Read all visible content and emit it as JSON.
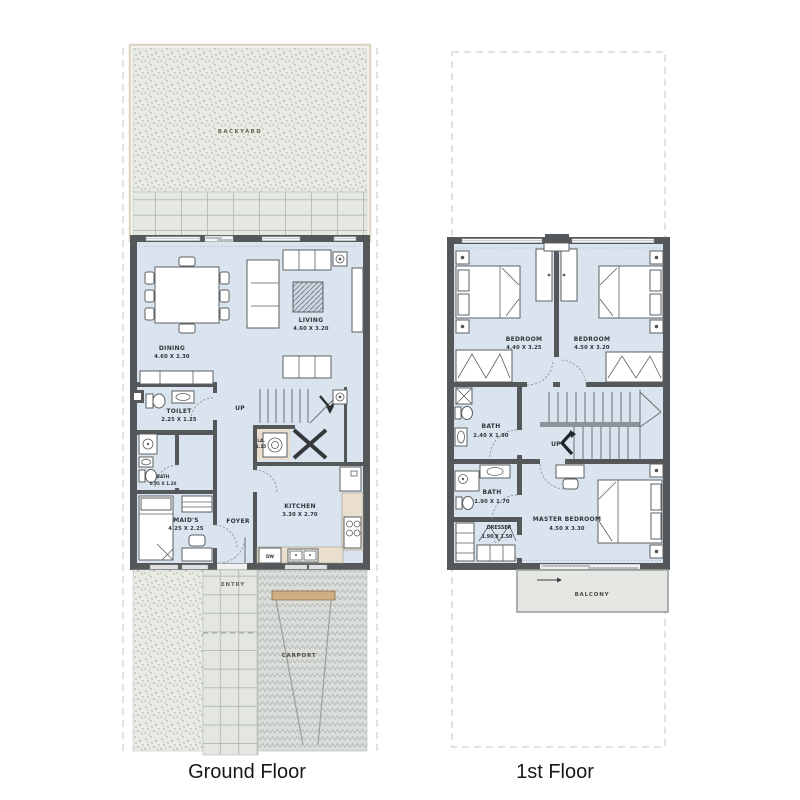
{
  "titles": {
    "ground": "Ground Floor",
    "first": "1st Floor"
  },
  "colors": {
    "wall": "#54585a",
    "floor": "#d9e4ee",
    "counter_tan": "#eadfcf",
    "beam_tan": "#d0ad83",
    "balcony_gray": "#e4e7e2",
    "gravel": "#e9ebe5",
    "tile": "#e6e9e3"
  },
  "ground_floor": {
    "outdoor": {
      "backyard": "BACKYARD",
      "entry": "ENTRY",
      "carport": "CARPORT"
    },
    "rooms": {
      "dining": {
        "name": "DINING",
        "dims": "4.60 X 2.30"
      },
      "living": {
        "name": "LIVING",
        "dims": "4.60 X 3.20"
      },
      "toilet": {
        "name": "TOILET",
        "dims": "2.25 X 1.25"
      },
      "bath": {
        "name": "BATH",
        "dims": "0.95 X 1.20"
      },
      "maids": {
        "name": "MAID'S",
        "dims": "4.25 X 2.25"
      },
      "foyer": {
        "name": "FOYER"
      },
      "kitchen": {
        "name": "KITCHEN",
        "dims": "3.30 X 2.70"
      },
      "laundry": {
        "name": "LA.",
        "dims": "1.15"
      }
    },
    "annotations": {
      "up": "UP",
      "dw": "DW"
    }
  },
  "first_floor": {
    "rooms": {
      "bedroom_left": {
        "name": "BEDROOM",
        "dims": "4.40 X 3.25"
      },
      "bedroom_right": {
        "name": "BEDROOM",
        "dims": "4.50 X 3.20"
      },
      "bath_top": {
        "name": "BATH",
        "dims": "2.40 X 1.90"
      },
      "bath_bottom": {
        "name": "BATH",
        "dims": "1.90 X 1.70"
      },
      "dresser": {
        "name": "DRESSER",
        "dims": "1.90 X 1.50"
      },
      "master": {
        "name": "MASTER BEDROOM",
        "dims": "4.50 X 3.30"
      },
      "balcony": {
        "name": "BALCONY"
      }
    },
    "annotations": {
      "up": "UP"
    }
  }
}
